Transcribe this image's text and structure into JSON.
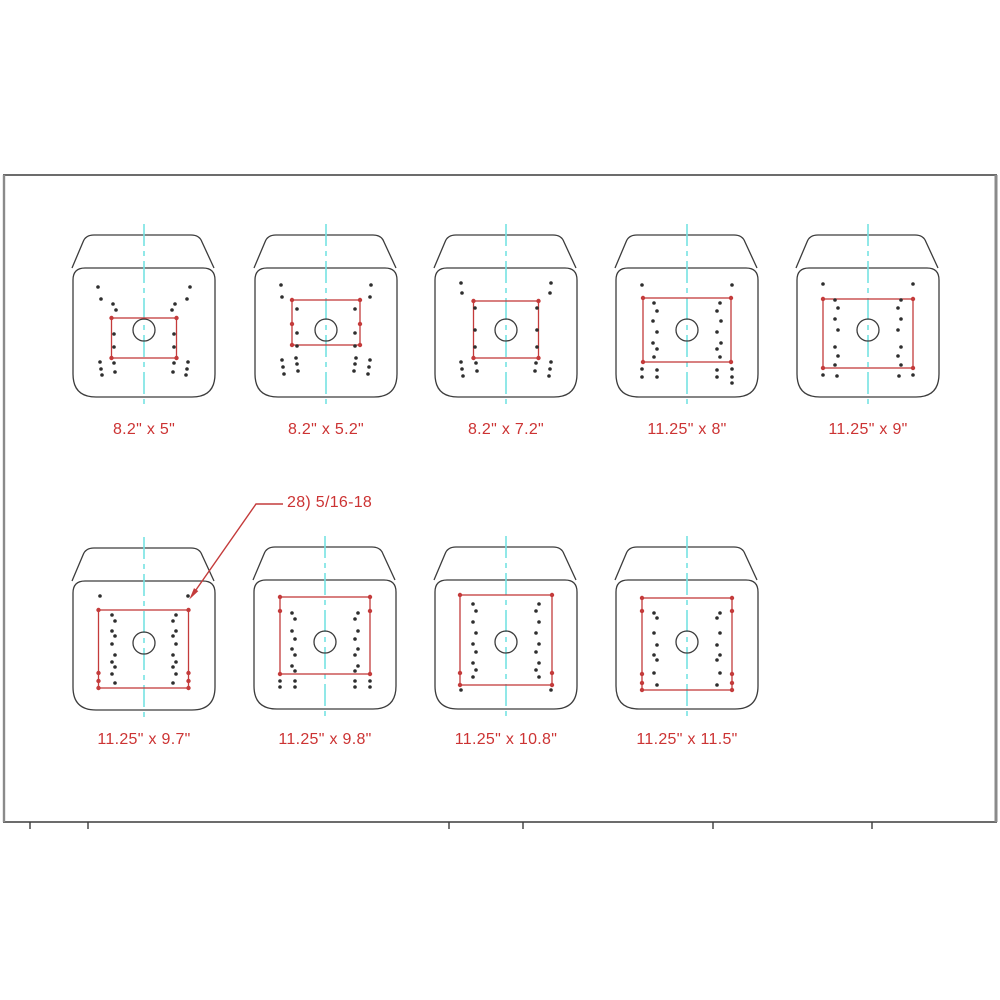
{
  "colors": {
    "bg": "#ffffff",
    "outline": "#3c3c3c",
    "red": "#c43b3b",
    "label": "#cc3333",
    "centerline": "#76e3e3",
    "hole": "#2e2e2e",
    "frame": "#3c3c3c",
    "frame_side": "#8a8a8a"
  },
  "frame": {
    "left": 3,
    "top": 175,
    "right": 997,
    "bottom": 822,
    "tick_xs": [
      30,
      88,
      449,
      523,
      713,
      872
    ],
    "tick_len": 7
  },
  "annotation": {
    "text": "28) 5/16-18",
    "text_x": 287,
    "text_y": 503,
    "leader": [
      [
        283,
        504
      ],
      [
        256,
        504
      ],
      [
        191,
        597
      ]
    ]
  },
  "seats": [
    {
      "label": "8.2\" x 5\"",
      "cx": 144,
      "cy": 330,
      "label_y": 430,
      "rect": {
        "x": -32.5,
        "y": -12,
        "w": 65,
        "h": 40
      },
      "red_dots": [
        [
          -32.5,
          -12
        ],
        [
          32.5,
          -12
        ],
        [
          -32.5,
          28
        ],
        [
          32.5,
          28
        ]
      ],
      "holes": [
        [
          -46,
          -43
        ],
        [
          -43,
          -31
        ],
        [
          46,
          -43
        ],
        [
          43,
          -31
        ],
        [
          -31,
          -26
        ],
        [
          -28,
          -20
        ],
        [
          31,
          -26
        ],
        [
          28,
          -20
        ],
        [
          -30,
          4
        ],
        [
          -30,
          17
        ],
        [
          30,
          4
        ],
        [
          30,
          17
        ],
        [
          -30,
          33
        ],
        [
          -29,
          42
        ],
        [
          30,
          33
        ],
        [
          29,
          42
        ],
        [
          -44,
          32
        ],
        [
          -43,
          39
        ],
        [
          -42,
          45
        ],
        [
          44,
          32
        ],
        [
          43,
          39
        ],
        [
          42,
          45
        ]
      ]
    },
    {
      "label": "8.2\" x 5.2\"",
      "cx": 326,
      "cy": 330,
      "label_y": 430,
      "rect": {
        "x": -34,
        "y": -30,
        "w": 68,
        "h": 45
      },
      "red_dots": [
        [
          -34,
          -30
        ],
        [
          34,
          -30
        ],
        [
          -34,
          15
        ],
        [
          34,
          15
        ],
        [
          -34,
          -6
        ],
        [
          34,
          -6
        ]
      ],
      "holes": [
        [
          -45,
          -45
        ],
        [
          -44,
          -33
        ],
        [
          45,
          -45
        ],
        [
          44,
          -33
        ],
        [
          -29,
          -21
        ],
        [
          29,
          -21
        ],
        [
          -29,
          3
        ],
        [
          29,
          3
        ],
        [
          -29,
          16
        ],
        [
          29,
          16
        ],
        [
          -44,
          30
        ],
        [
          -43,
          37
        ],
        [
          -42,
          44
        ],
        [
          44,
          30
        ],
        [
          43,
          37
        ],
        [
          42,
          44
        ],
        [
          -30,
          28
        ],
        [
          -29,
          34
        ],
        [
          -28,
          41
        ],
        [
          30,
          28
        ],
        [
          29,
          34
        ],
        [
          28,
          41
        ]
      ]
    },
    {
      "label": "8.2\" x 7.2\"",
      "cx": 506,
      "cy": 330,
      "label_y": 430,
      "rect": {
        "x": -32.5,
        "y": -29,
        "w": 65,
        "h": 57
      },
      "red_dots": [
        [
          -32.5,
          -29
        ],
        [
          32.5,
          -29
        ],
        [
          -32.5,
          28
        ],
        [
          32.5,
          28
        ]
      ],
      "holes": [
        [
          -45,
          -47
        ],
        [
          -44,
          -37
        ],
        [
          45,
          -47
        ],
        [
          44,
          -37
        ],
        [
          -31,
          -22
        ],
        [
          -31,
          0
        ],
        [
          -31,
          17
        ],
        [
          31,
          -22
        ],
        [
          31,
          0
        ],
        [
          31,
          17
        ],
        [
          -30,
          33
        ],
        [
          -29,
          41
        ],
        [
          30,
          33
        ],
        [
          29,
          41
        ],
        [
          -45,
          32
        ],
        [
          -44,
          39
        ],
        [
          -43,
          46
        ],
        [
          45,
          32
        ],
        [
          44,
          39
        ],
        [
          43,
          46
        ]
      ]
    },
    {
      "label": "11.25\" x 8\"",
      "cx": 687,
      "cy": 330,
      "label_y": 430,
      "rect": {
        "x": -44,
        "y": -32,
        "w": 88,
        "h": 64
      },
      "red_dots": [
        [
          -44,
          -32
        ],
        [
          44,
          -32
        ],
        [
          -44,
          32
        ],
        [
          44,
          32
        ]
      ],
      "holes": [
        [
          -45,
          -45
        ],
        [
          45,
          -45
        ],
        [
          -33,
          -27
        ],
        [
          -30,
          -19
        ],
        [
          -34,
          -9
        ],
        [
          -30,
          2
        ],
        [
          -34,
          13
        ],
        [
          -30,
          19
        ],
        [
          -33,
          27
        ],
        [
          33,
          -27
        ],
        [
          30,
          -19
        ],
        [
          34,
          -9
        ],
        [
          30,
          2
        ],
        [
          34,
          13
        ],
        [
          30,
          19
        ],
        [
          33,
          27
        ],
        [
          -45,
          39
        ],
        [
          -30,
          40
        ],
        [
          -45,
          47
        ],
        [
          -30,
          47
        ],
        [
          45,
          39
        ],
        [
          30,
          40
        ],
        [
          45,
          47
        ],
        [
          30,
          47
        ],
        [
          45,
          53
        ]
      ]
    },
    {
      "label": "11.25\" x 9\"",
      "cx": 868,
      "cy": 330,
      "label_y": 430,
      "rect": {
        "x": -45,
        "y": -31,
        "w": 90,
        "h": 69
      },
      "red_dots": [
        [
          -45,
          -31
        ],
        [
          45,
          -31
        ],
        [
          -45,
          38
        ],
        [
          45,
          38
        ]
      ],
      "holes": [
        [
          -45,
          -46
        ],
        [
          45,
          -46
        ],
        [
          -33,
          -30
        ],
        [
          -30,
          -22
        ],
        [
          -33,
          -11
        ],
        [
          -30,
          0
        ],
        [
          -33,
          17
        ],
        [
          -30,
          26
        ],
        [
          -33,
          35
        ],
        [
          33,
          -30
        ],
        [
          30,
          -22
        ],
        [
          33,
          -11
        ],
        [
          30,
          0
        ],
        [
          33,
          17
        ],
        [
          30,
          26
        ],
        [
          33,
          35
        ],
        [
          -45,
          45
        ],
        [
          -31,
          46
        ],
        [
          45,
          45
        ],
        [
          31,
          46
        ]
      ]
    },
    {
      "label": "11.25\" x 9.7\"",
      "cx": 144,
      "cy": 643,
      "label_y": 740,
      "rect": {
        "x": -45.5,
        "y": -33,
        "w": 90,
        "h": 78
      },
      "red_dots": [
        [
          -45.5,
          -33
        ],
        [
          44.5,
          -33
        ],
        [
          -45.5,
          45
        ],
        [
          44.5,
          45
        ],
        [
          -45.5,
          30
        ],
        [
          -45.5,
          38
        ],
        [
          44.5,
          30
        ],
        [
          44.5,
          38
        ]
      ],
      "holes": [
        [
          -44,
          -47
        ],
        [
          44,
          -47
        ],
        [
          -32,
          -28
        ],
        [
          -29,
          -22
        ],
        [
          -32,
          -12
        ],
        [
          -29,
          -7
        ],
        [
          -32,
          1
        ],
        [
          -29,
          12
        ],
        [
          -32,
          19
        ],
        [
          -29,
          24
        ],
        [
          -32,
          31
        ],
        [
          -29,
          40
        ],
        [
          32,
          -28
        ],
        [
          29,
          -22
        ],
        [
          32,
          -12
        ],
        [
          29,
          -7
        ],
        [
          32,
          1
        ],
        [
          29,
          12
        ],
        [
          32,
          19
        ],
        [
          29,
          24
        ],
        [
          32,
          31
        ],
        [
          29,
          40
        ]
      ]
    },
    {
      "label": "11.25\" x 9.8\"",
      "cx": 325,
      "cy": 642,
      "label_y": 740,
      "rect": {
        "x": -45,
        "y": -45,
        "w": 90,
        "h": 77
      },
      "red_dots": [
        [
          -45,
          -45
        ],
        [
          45,
          -45
        ],
        [
          -45,
          32
        ],
        [
          45,
          32
        ],
        [
          -45,
          -31
        ],
        [
          45,
          -31
        ]
      ],
      "holes": [
        [
          -33,
          -29
        ],
        [
          -30,
          -23
        ],
        [
          -33,
          -11
        ],
        [
          -30,
          -3
        ],
        [
          -33,
          7
        ],
        [
          -30,
          13
        ],
        [
          -33,
          24
        ],
        [
          -30,
          29
        ],
        [
          33,
          -29
        ],
        [
          30,
          -23
        ],
        [
          33,
          -11
        ],
        [
          30,
          -3
        ],
        [
          33,
          7
        ],
        [
          30,
          13
        ],
        [
          33,
          24
        ],
        [
          30,
          29
        ],
        [
          -45,
          39
        ],
        [
          -45,
          45
        ],
        [
          -30,
          39
        ],
        [
          -30,
          45
        ],
        [
          45,
          39
        ],
        [
          45,
          45
        ],
        [
          30,
          39
        ],
        [
          30,
          45
        ]
      ]
    },
    {
      "label": "11.25\" x 10.8\"",
      "cx": 506,
      "cy": 642,
      "label_y": 740,
      "rect": {
        "x": -46,
        "y": -47,
        "w": 92,
        "h": 90
      },
      "red_dots": [
        [
          -46,
          -47
        ],
        [
          46,
          -47
        ],
        [
          -46,
          43
        ],
        [
          46,
          43
        ],
        [
          -46,
          31
        ],
        [
          46,
          31
        ]
      ],
      "holes": [
        [
          -33,
          -38
        ],
        [
          -30,
          -31
        ],
        [
          -33,
          -20
        ],
        [
          -30,
          -9
        ],
        [
          -33,
          2
        ],
        [
          -30,
          10
        ],
        [
          -33,
          21
        ],
        [
          -30,
          28
        ],
        [
          -33,
          35
        ],
        [
          33,
          -38
        ],
        [
          30,
          -31
        ],
        [
          33,
          -20
        ],
        [
          30,
          -9
        ],
        [
          33,
          2
        ],
        [
          30,
          10
        ],
        [
          33,
          21
        ],
        [
          30,
          28
        ],
        [
          33,
          35
        ],
        [
          -45,
          48
        ],
        [
          45,
          48
        ]
      ]
    },
    {
      "label": "11.25\" x 11.5\"",
      "cx": 687,
      "cy": 642,
      "label_y": 740,
      "rect": {
        "x": -45,
        "y": -44,
        "w": 90,
        "h": 92
      },
      "red_dots": [
        [
          -45,
          -44
        ],
        [
          45,
          -44
        ],
        [
          -45,
          48
        ],
        [
          45,
          48
        ],
        [
          -45,
          -31
        ],
        [
          45,
          -31
        ],
        [
          -45,
          32
        ],
        [
          -45,
          41
        ],
        [
          45,
          32
        ],
        [
          45,
          41
        ]
      ],
      "holes": [
        [
          -33,
          -29
        ],
        [
          -30,
          -24
        ],
        [
          -33,
          -9
        ],
        [
          -30,
          3
        ],
        [
          -33,
          13
        ],
        [
          -30,
          18
        ],
        [
          -33,
          31
        ],
        [
          -30,
          43
        ],
        [
          33,
          -29
        ],
        [
          30,
          -24
        ],
        [
          33,
          -9
        ],
        [
          30,
          3
        ],
        [
          33,
          13
        ],
        [
          30,
          18
        ],
        [
          33,
          31
        ],
        [
          30,
          43
        ]
      ]
    }
  ]
}
